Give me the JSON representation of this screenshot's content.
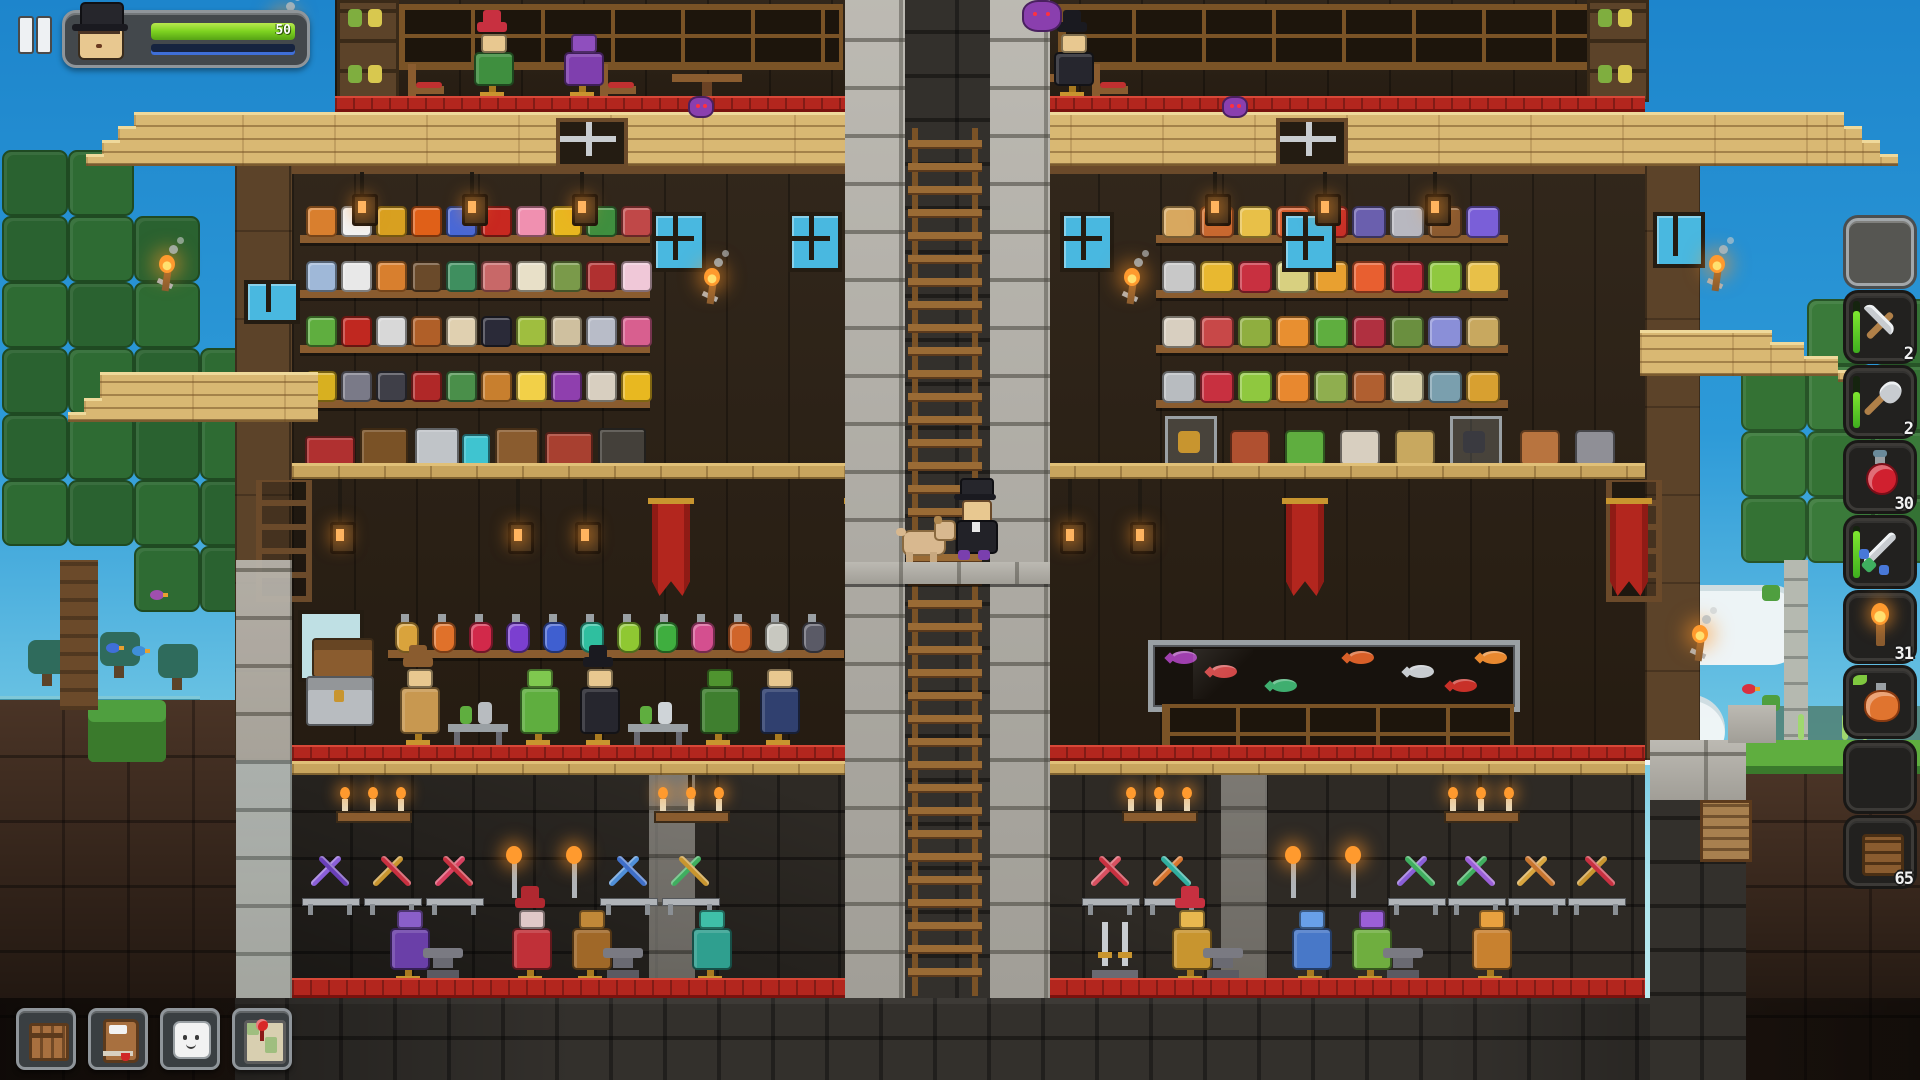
{
  "hud": {
    "pause_icon": "pause-icon",
    "portrait": {
      "hat": "top-hat",
      "skin": "#e8c890"
    },
    "health": {
      "value": "50",
      "fill_top": "#b8e84f",
      "fill": "#7ed321",
      "fill_dark": "#56a315"
    },
    "stamina": {
      "track": "#16233f",
      "stripe": "#3f6fd8"
    }
  },
  "hotbar": {
    "slots": [
      {
        "item": "empty",
        "selected": true
      },
      {
        "item": "pickaxe",
        "count": "2",
        "durability": 0.8
      },
      {
        "item": "shovel",
        "count": "2",
        "durability": 0.7
      },
      {
        "item": "health-potion",
        "count": "30"
      },
      {
        "item": "sword",
        "durability": 0.9
      },
      {
        "item": "torch",
        "count": "31"
      },
      {
        "item": "stamina-potion"
      },
      {
        "item": "empty"
      },
      {
        "item": "wood-planks",
        "count": "65"
      }
    ]
  },
  "toolbar": {
    "buttons": [
      {
        "name": "inventory",
        "icon": "crate-icon"
      },
      {
        "name": "journal",
        "icon": "book-icon"
      },
      {
        "name": "chat",
        "icon": "chat-icon"
      },
      {
        "name": "map",
        "icon": "map-icon"
      }
    ]
  },
  "scene": {
    "palette": {
      "wood_wall": "#2b2014",
      "ext_wall": "#5c4329",
      "roof": "#d9b873",
      "stone_light": "#b3b0a8",
      "stone_dark": "#33302c",
      "carpet": "#b3261e",
      "floor": "#c8a55e",
      "canopy": "#2e6b33",
      "trunk": "#6b4a2a",
      "birch": "#b5b9b0",
      "flame": "#ff9a2e",
      "glass": "#49b8e0"
    },
    "left_shelf_rows": [
      [
        "#d97f2e",
        "#f2f2f2",
        "#d8a020",
        "#e06018",
        "#4868d8",
        "#c82820",
        "#f090b0",
        "#e8b820",
        "#3f8f3f",
        "#c04848"
      ],
      [
        "#9fb8d8",
        "#e8e8e8",
        "#d87f2e",
        "#6a4a2a",
        "#3f8f5f",
        "#c86868",
        "#e8e0c8",
        "#7a9a4a",
        "#b03030",
        "#f0c8d8"
      ],
      [
        "#5fae3f",
        "#c02820",
        "#d8d8d8",
        "#b05f28",
        "#e0d0b0",
        "#2a2a38",
        "#9fbe3f",
        "#cfc09f",
        "#b8bcc8",
        "#d85f8f"
      ],
      [
        "#d8b020",
        "#7a7a88",
        "#3f3f48",
        "#b02828",
        "#4a8f4a",
        "#c87f2e",
        "#f2d048",
        "#8f3fae",
        "#d8cfc0",
        "#e8b820"
      ]
    ],
    "right_shelf_rows": [
      [
        "#d8a85f",
        "#c86830",
        "#e8c048",
        "#d85f2e",
        "#c83028",
        "#6a5fae",
        "#b8b8c0",
        "#8a5a30",
        "#7a5fd8"
      ],
      [
        "#c8c8c8",
        "#e8b830",
        "#c83040",
        "#d8d080",
        "#e8a030",
        "#e85f30",
        "#c8303f",
        "#8fc83f",
        "#e8c048"
      ],
      [
        "#d8cfc0",
        "#c84848",
        "#8fae3f",
        "#e88f30",
        "#5fae3f",
        "#b03040",
        "#6a8f3f",
        "#8a8fd8",
        "#c8a85f"
      ],
      [
        "#b8bcc0",
        "#c83040",
        "#8fc83f",
        "#e8882f",
        "#8fae4f",
        "#b05f30",
        "#d8cfa8",
        "#7a9fae",
        "#d8a030"
      ]
    ],
    "furniture_left": [
      {
        "x": 305,
        "c": "#b03030",
        "w": 46,
        "h": 26
      },
      {
        "x": 360,
        "c": "#7a5226",
        "w": 44,
        "h": 34
      },
      {
        "x": 415,
        "c": "#c0c4c8",
        "w": 40,
        "h": 34
      },
      {
        "x": 462,
        "c": "#3fc4d0",
        "w": 24,
        "h": 28
      },
      {
        "x": 495,
        "c": "#8a5c2f",
        "w": 40,
        "h": 34
      },
      {
        "x": 545,
        "c": "#a84030",
        "w": 44,
        "h": 30
      },
      {
        "x": 598,
        "c": "#44403a",
        "w": 44,
        "h": 34
      }
    ],
    "display_right": [
      {
        "x": 1165,
        "c": "#c8952f",
        "cs": true
      },
      {
        "x": 1230,
        "c": "#b05030"
      },
      {
        "x": 1285,
        "c": "#5fae3f"
      },
      {
        "x": 1340,
        "c": "#d8cfc0"
      },
      {
        "x": 1395,
        "c": "#c8a85f"
      },
      {
        "x": 1450,
        "c": "#3a3a40",
        "cs": true
      },
      {
        "x": 1520,
        "c": "#b8743f"
      },
      {
        "x": 1575,
        "c": "#8f8f96"
      }
    ],
    "potion_colors": [
      "#d9a33c",
      "#e0712a",
      "#d2294a",
      "#7b3fd0",
      "#3f5fd0",
      "#2fbf9f",
      "#8fc832",
      "#3fae3f",
      "#d44f8f",
      "#d0652a",
      "#c8c8c0",
      "#5a5a66"
    ],
    "aquarium_fish": [
      {
        "x": 18,
        "c": "#9f3fae"
      },
      {
        "x": 58,
        "c": "#d04848"
      },
      {
        "x": 118,
        "c": "#3fae6f"
      },
      {
        "x": 195,
        "c": "#d85f28"
      },
      {
        "x": 255,
        "c": "#c8ccd0"
      },
      {
        "x": 298,
        "c": "#c83028"
      },
      {
        "x": 328,
        "c": "#e8882f"
      }
    ],
    "weapon_racks": [
      {
        "x": 302,
        "a": "#8a5fd8",
        "b": "#6a3fb8"
      },
      {
        "x": 364,
        "a": "#c8952f",
        "b": "#c83040"
      },
      {
        "x": 426,
        "a": "#d84060",
        "b": "#c83040"
      },
      {
        "x": 600,
        "a": "#4f8fd8",
        "b": "#3f6fc8"
      },
      {
        "x": 662,
        "a": "#3fae5f",
        "b": "#c8952f"
      },
      {
        "x": 1082,
        "a": "#d85060",
        "b": "#c83040"
      },
      {
        "x": 1144,
        "a": "#d8752f",
        "b": "#2fae9f"
      },
      {
        "x": 1388,
        "a": "#8a5fd8",
        "b": "#3fae5f"
      },
      {
        "x": 1448,
        "a": "#3fae5f",
        "b": "#9b5fd8"
      },
      {
        "x": 1508,
        "a": "#d8a53f",
        "b": "#c8752f"
      },
      {
        "x": 1568,
        "a": "#c8952f",
        "b": "#c83040"
      }
    ],
    "sconces_x": [
      506,
      566,
      1285,
      1345
    ],
    "chandeliers_x": [
      372,
      690,
      1158,
      1480
    ],
    "pilasters_x": [
      649,
      1221
    ],
    "armor_stands": [
      {
        "x": 378,
        "c": "#6a3fa8",
        "h": "#8a5fc8"
      },
      {
        "x": 500,
        "c": "#c03038",
        "h": "#e0c8c8",
        "hat": "#b02830"
      },
      {
        "x": 560,
        "c": "#a06828",
        "h": "#c08838"
      },
      {
        "x": 680,
        "c": "#2f9f8f",
        "h": "#3fbfa8"
      },
      {
        "x": 1160,
        "c": "#c8952f",
        "h": "#e8b84f",
        "hat": "#c83040"
      },
      {
        "x": 1280,
        "c": "#4878c8",
        "h": "#68a0e8"
      },
      {
        "x": 1340,
        "c": "#6fae3f",
        "h": "#9b5fd8"
      },
      {
        "x": 1460,
        "c": "#c8812f",
        "h": "#e8a13f"
      }
    ],
    "anvils_x": [
      440,
      620,
      1220,
      1400
    ],
    "sword_display_x": 1090,
    "costume_stands": [
      {
        "x": 388,
        "c": "#c89850",
        "h": "#e8c890",
        "hat": "#8a5c2f"
      },
      {
        "x": 448,
        "bench": true,
        "c": "#b8bcc0"
      },
      {
        "x": 508,
        "c": "#5fae3f",
        "h": "#7fc84f"
      },
      {
        "x": 568,
        "c": "#26262e",
        "h": "#e8c890",
        "hat": "#1a1a20"
      },
      {
        "x": 628,
        "bench": true,
        "c": "#cfd4d8"
      },
      {
        "x": 688,
        "c": "#3f7f2f",
        "h": "#4f942f"
      },
      {
        "x": 748,
        "c": "#30406f",
        "h": "#e8c890"
      }
    ],
    "top_stands": [
      {
        "x": 462,
        "c": "#3f8f3f",
        "h": "#e8c890",
        "hat": "#c83040"
      },
      {
        "x": 552,
        "c": "#7f3fae",
        "h": "#8f4fbe"
      },
      {
        "x": 948,
        "c": "#9aa2ae",
        "h": "#b8c0cc"
      },
      {
        "x": 1042,
        "c": "#26262e",
        "h": "#e8c890",
        "hat": "#1a1a20"
      }
    ],
    "top_chairs_x": [
      408,
      600,
      896,
      1092
    ],
    "top_tables_x": [
      672,
      1008
    ],
    "banners_x": [
      652,
      848,
      1286,
      1610
    ],
    "hall_windows": [
      [
        652,
        212
      ],
      [
        788,
        212
      ],
      [
        1060,
        212
      ],
      [
        1282,
        212
      ]
    ],
    "ext_windows": [
      [
        244,
        280,
        48,
        36
      ],
      [
        1653,
        212,
        44,
        48
      ]
    ],
    "wall_torches": [
      [
        272,
        12
      ],
      [
        155,
        255
      ],
      [
        1705,
        255
      ],
      [
        1688,
        625
      ],
      [
        700,
        268
      ],
      [
        1120,
        268
      ]
    ],
    "hook_lanterns": [
      [
        352,
        172
      ],
      [
        462,
        172
      ],
      [
        572,
        172
      ],
      [
        1205,
        172
      ],
      [
        1315,
        172
      ],
      [
        1425,
        172
      ]
    ],
    "mid_lanterns": [
      [
        330,
        478
      ],
      [
        508,
        478
      ],
      [
        575,
        478
      ],
      [
        1060,
        478
      ],
      [
        1130,
        478
      ]
    ],
    "canopy_left": [
      [
        2,
        150
      ],
      [
        68,
        150
      ],
      [
        2,
        216
      ],
      [
        68,
        216
      ],
      [
        134,
        216
      ],
      [
        2,
        282
      ],
      [
        68,
        282
      ],
      [
        134,
        282
      ],
      [
        2,
        348
      ],
      [
        68,
        348
      ],
      [
        134,
        348
      ],
      [
        200,
        348
      ],
      [
        2,
        414
      ],
      [
        68,
        414
      ],
      [
        134,
        414
      ],
      [
        200,
        414
      ],
      [
        266,
        414
      ],
      [
        2,
        480
      ],
      [
        68,
        480
      ],
      [
        134,
        480
      ],
      [
        200,
        480
      ],
      [
        134,
        546
      ],
      [
        200,
        546
      ]
    ],
    "canopy_right": [
      [
        1741,
        365
      ],
      [
        1807,
        365
      ],
      [
        1873,
        365
      ],
      [
        1741,
        431
      ],
      [
        1807,
        431
      ],
      [
        1873,
        431
      ],
      [
        1741,
        497
      ],
      [
        1807,
        497
      ],
      [
        1873,
        497
      ],
      [
        1807,
        299
      ],
      [
        1873,
        299
      ]
    ],
    "trunks_left": [
      [
        60,
        560,
        38,
        150
      ],
      [
        238,
        560,
        34,
        150
      ]
    ],
    "small_trees": [
      [
        28,
        640
      ],
      [
        100,
        632
      ],
      [
        158,
        644
      ]
    ],
    "birds": [
      [
        150,
        588,
        "#9f4fae"
      ],
      [
        106,
        641,
        "#3f6fd8"
      ],
      [
        132,
        644,
        "#3f8fd8"
      ],
      [
        1742,
        682,
        "#d83040"
      ]
    ],
    "grass_blades_right": [
      1690,
      1798,
      1842,
      1862
    ],
    "clouds": [
      [
        1545,
        585,
        260,
        80
      ],
      [
        1560,
        695,
        165,
        70
      ]
    ],
    "spiders": [
      [
        688,
        96
      ],
      [
        1222,
        96
      ],
      [
        1022,
        0
      ]
    ]
  }
}
